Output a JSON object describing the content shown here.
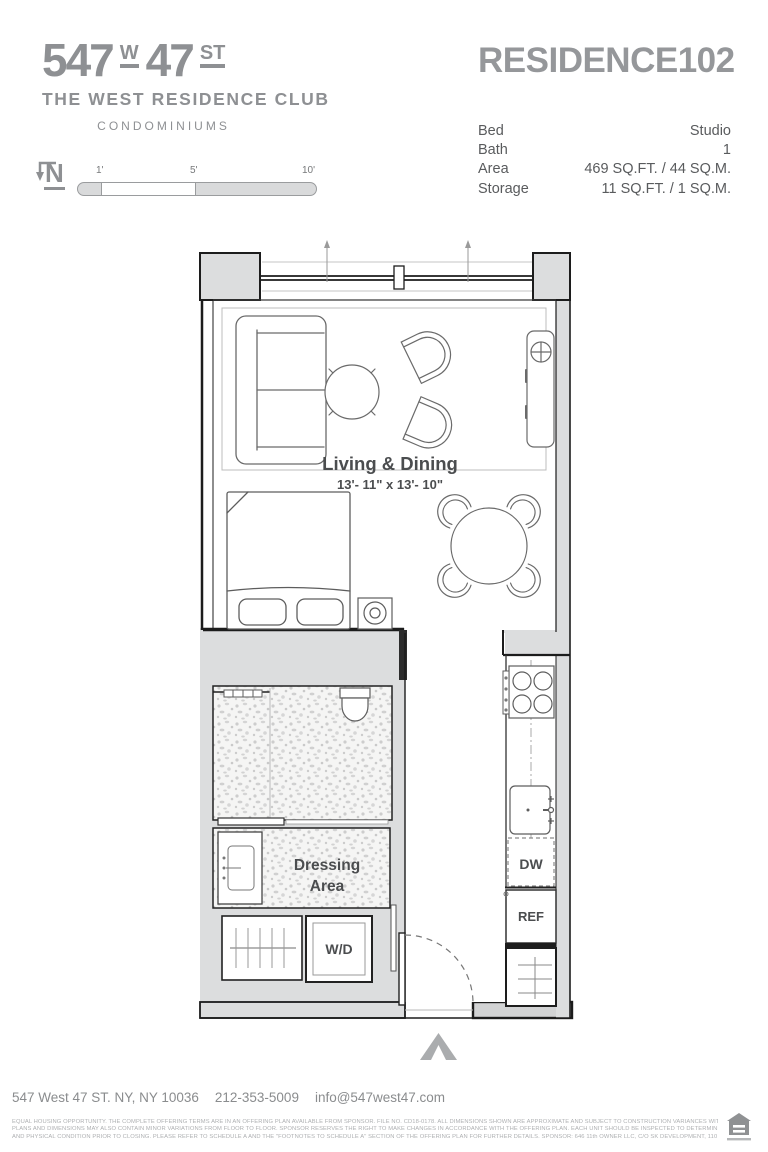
{
  "logo": {
    "street_number": "547",
    "w": "W",
    "street_number2": "47",
    "st": "ST",
    "building_name": "THE WEST RESIDENCE CLUB",
    "building_type": "CONDOMINIUMS"
  },
  "residence": {
    "label": "RESIDENCE",
    "unit": "102"
  },
  "details": {
    "rows": [
      {
        "label": "Bed",
        "value": "Studio"
      },
      {
        "label": "Bath",
        "value": "1"
      },
      {
        "label": "Area",
        "value": "469 SQ.FT. / 44 SQ.M."
      },
      {
        "label": "Storage",
        "value": "11 SQ.FT. / 1 SQ.M."
      }
    ]
  },
  "compass": {
    "north": "N"
  },
  "scale_bar": {
    "ticks": [
      "1'",
      "5'",
      "10'"
    ]
  },
  "plan": {
    "living_label": "Living & Dining",
    "living_dims": "13'- 11\" x 13'- 10\"",
    "dressing_label_line1": "Dressing",
    "dressing_label_line2": "Area",
    "washer_dryer": "W/D",
    "dishwasher": "DW",
    "refrigerator": "REF"
  },
  "footer": {
    "address": "547 West 47 ST. NY, NY 10036",
    "phone": "212-353-5009",
    "email": "info@547west47.com",
    "disclaimer_line1": "EQUAL HOUSING OPPORTUNITY. THE COMPLETE OFFERING TERMS ARE IN AN OFFERING PLAN AVAILABLE FROM SPONSOR. FILE NO. CD18-0178. ALL DIMENSIONS SHOWN ARE APPROXIMATE AND SUBJECT TO CONSTRUCTION VARIANCES WITHIN REASONABLE TOLERANCES.",
    "disclaimer_line2": "PLANS AND DIMENSIONS MAY ALSO CONTAIN MINOR VARIATIONS FROM FLOOR TO FLOOR. SPONSOR RESERVES THE RIGHT TO MAKE CHANGES IN ACCORDANCE WITH THE OFFERING PLAN. EACH UNIT SHOULD BE INSPECTED TO DETERMINE ITS ACTUAL DIMENSIONS, LAYOUT",
    "disclaimer_line3": "AND PHYSICAL CONDITION PRIOR TO CLOSING. PLEASE REFER TO SCHEDULE A AND THE \"FOOTNOTES TO SCHEDULE A\" SECTION OF THE OFFERING PLAN FOR FURTHER DETAILS. SPONSOR: 646 11th OWNER LLC, C/O SK DEVELOPMENT, 110 GREENE STREET, 901, NEW YORK, NY 10012."
  },
  "colors": {
    "brand_gray": "#8e9093",
    "wall_gray": "#dcddde",
    "line_black": "#1c1c1c",
    "label_dark": "#4b4d4f"
  }
}
